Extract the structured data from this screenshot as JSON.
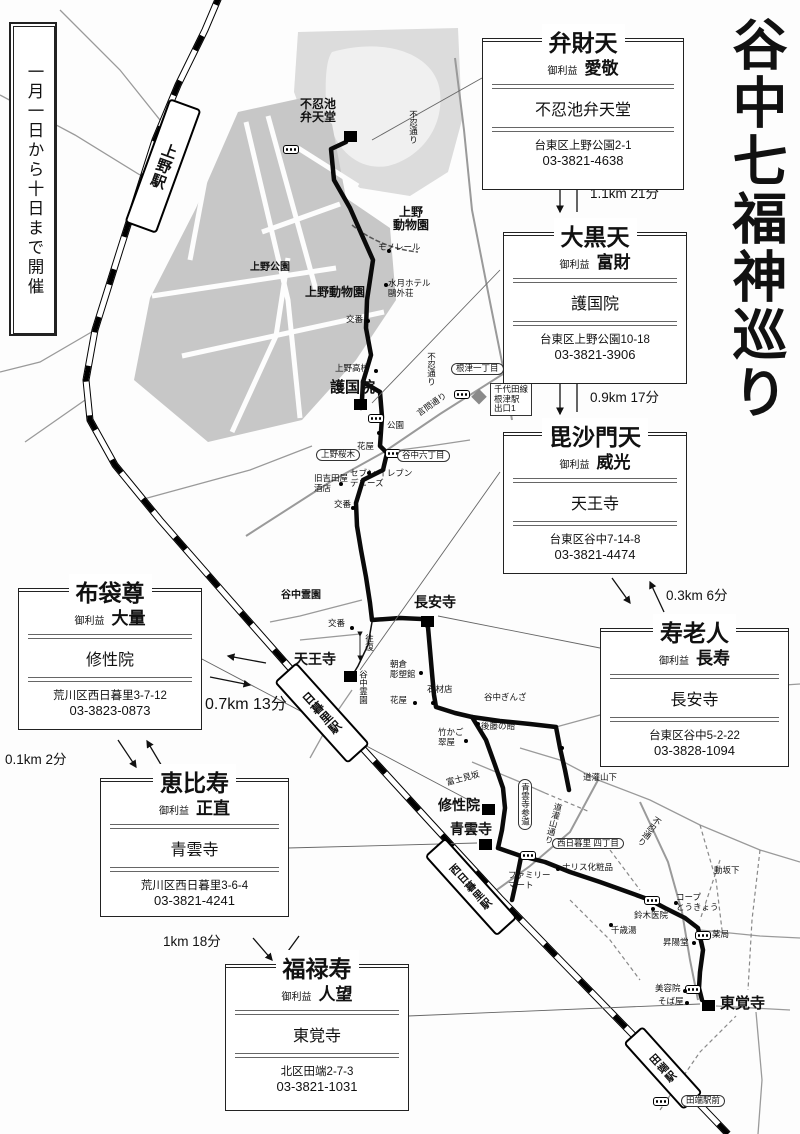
{
  "title": "谷中七福神巡り",
  "period": "一月一日から十日まで開催",
  "benefit_label": "御利益",
  "deities": [
    {
      "name": "弁財天",
      "benefit": "愛敬",
      "temple": "不忍池弁天堂",
      "address": "台東区上野公園2-1",
      "phone": "03-3821-4638"
    },
    {
      "name": "大黒天",
      "benefit": "富財",
      "temple": "護国院",
      "address": "台東区上野公園10-18",
      "phone": "03-3821-3906"
    },
    {
      "name": "毘沙門天",
      "benefit": "威光",
      "temple": "天王寺",
      "address": "台東区谷中7-14-8",
      "phone": "03-3821-4474"
    },
    {
      "name": "寿老人",
      "benefit": "長寿",
      "temple": "長安寺",
      "address": "台東区谷中5-2-22",
      "phone": "03-3828-1094"
    },
    {
      "name": "布袋尊",
      "benefit": "大量",
      "temple": "修性院",
      "address": "荒川区西日暮里3-7-12",
      "phone": "03-3823-0873"
    },
    {
      "name": "恵比寿",
      "benefit": "正直",
      "temple": "青雲寺",
      "address": "荒川区西日暮里3-6-4",
      "phone": "03-3821-4241"
    },
    {
      "name": "福禄寿",
      "benefit": "人望",
      "temple": "東覚寺",
      "address": "北区田端2-7-3",
      "phone": "03-3821-1031"
    }
  ],
  "legs": [
    {
      "label": "1.1km 21分"
    },
    {
      "label": "0.9km 17分"
    },
    {
      "label": "0.3km 6分"
    },
    {
      "label": "0.7km 13分"
    },
    {
      "label": "0.1km 2分"
    },
    {
      "label": "1km 18分"
    }
  ],
  "map_labels": {
    "ueno_station": "上野駅",
    "benten_hall": "不忍池\n弁天堂",
    "zoo_east": "上野\n動物園",
    "monorail": "モノレール",
    "ueno_park": "上野公園",
    "zoo": "上野動物園",
    "suigetsu": "水月ホテル\n鷗外荘",
    "koban": "交番",
    "ueno_hs": "上野高校",
    "gokokuin": "護国院",
    "park_small": "公園",
    "nezu1": "根津一丁目",
    "chiyoda_exit": "千代田線\n根津駅\n出口1",
    "shinobazu_dori": "不忍通り",
    "kototoi_dori": "言問通り",
    "sakuragi": "上野桜木",
    "hanaya": "花屋",
    "yanaka6": "谷中六丁目",
    "seven": "セブン-イレブン\nデニーズ",
    "yoshidaya": "旧吉田屋\n酒店",
    "yanaka_cem": "谷中霊園",
    "choanji": "長安寺",
    "ohfuku": "往復",
    "tennoji": "天王寺",
    "asakura": "朝倉\n彫塑館",
    "sekizai": "石材店",
    "ginza": "谷中ぎんざ",
    "goto_ame": "後藤の飴",
    "takekago": "竹かご\n翠屋",
    "fujimizaka": "富士見坂",
    "shuseiin": "修性院",
    "seiunji": "青雲寺",
    "sando": "青雲寺参道",
    "dokan_shita": "道灌山下",
    "dokan_dori": "道灌山通り",
    "nishinippori4": "西日暮里\n四丁目",
    "naris": "ナリス化粧品",
    "famima": "ファミリー\nマート",
    "nippori_st": "日暮里駅",
    "nishinippori_st": "西日暮里駅",
    "tabata_st": "田端駅",
    "tabata_ekimae": "田端駅前",
    "suzuki": "鈴木医院",
    "coop": "コープ\nとうきょう",
    "chitose": "千歳湯",
    "shoyodo": "昇陽堂",
    "yakkyoku": "薬局",
    "biyoin": "美容院",
    "sobaya": "そば屋",
    "togakuji": "東覚寺",
    "dozaka_shita": "動坂下"
  }
}
